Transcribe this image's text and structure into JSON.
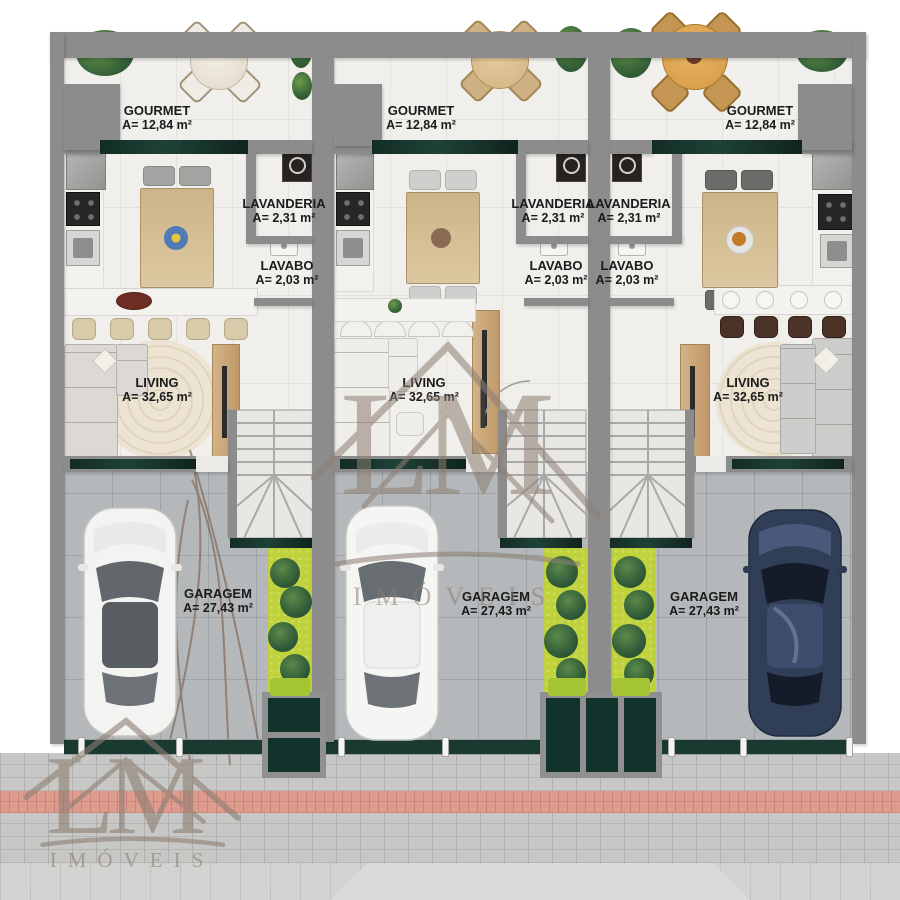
{
  "watermark": {
    "monogram": "LM",
    "label": "IMÓVEIS"
  },
  "units": [
    {
      "id": "unit-1",
      "car": "white",
      "gourmet": {
        "name": "GOURMET",
        "area": "A= 12,84 m²"
      },
      "lavanderia": {
        "name": "LAVANDERIA",
        "area": "A= 2,31 m²"
      },
      "lavabo": {
        "name": "LAVABO",
        "area": "A= 2,03 m²"
      },
      "living": {
        "name": "LIVING",
        "area": "A= 32,65 m²"
      },
      "garagem": {
        "name": "GARAGEM",
        "area": "A= 27,43 m²"
      }
    },
    {
      "id": "unit-2",
      "car": "white",
      "gourmet": {
        "name": "GOURMET",
        "area": "A= 12,84 m²"
      },
      "lavanderia": {
        "name": "LAVANDERIA",
        "area": "A= 2,31 m²"
      },
      "lavabo": {
        "name": "LAVABO",
        "area": "A= 2,03 m²"
      },
      "living": {
        "name": "LIVING",
        "area": "A= 32,65 m²"
      },
      "garagem": {
        "name": "GARAGEM",
        "area": "A= 27,43 m²"
      }
    },
    {
      "id": "unit-3",
      "car": "navy",
      "gourmet": {
        "name": "GOURMET",
        "area": "A= 12,84 m²"
      },
      "lavanderia": {
        "name": "LAVANDERIA",
        "area": "A= 2,31 m²"
      },
      "lavabo": {
        "name": "LAVABO",
        "area": "A= 2,03 m²"
      },
      "living": {
        "name": "LIVING",
        "area": "A= 32,65 m²"
      },
      "garagem": {
        "name": "GARAGEM",
        "area": "A= 27,43 m²"
      }
    }
  ],
  "colors": {
    "wall": "#8c8c8c",
    "counter_marble": "#15342c",
    "garage_floor": "#b4b8ba",
    "garden": "#bfd23c",
    "tactile_strip": "#dd9c8d",
    "watermark": "#8d7e73",
    "car_navy": "#303e58",
    "car_white": "#f3f3f1"
  }
}
